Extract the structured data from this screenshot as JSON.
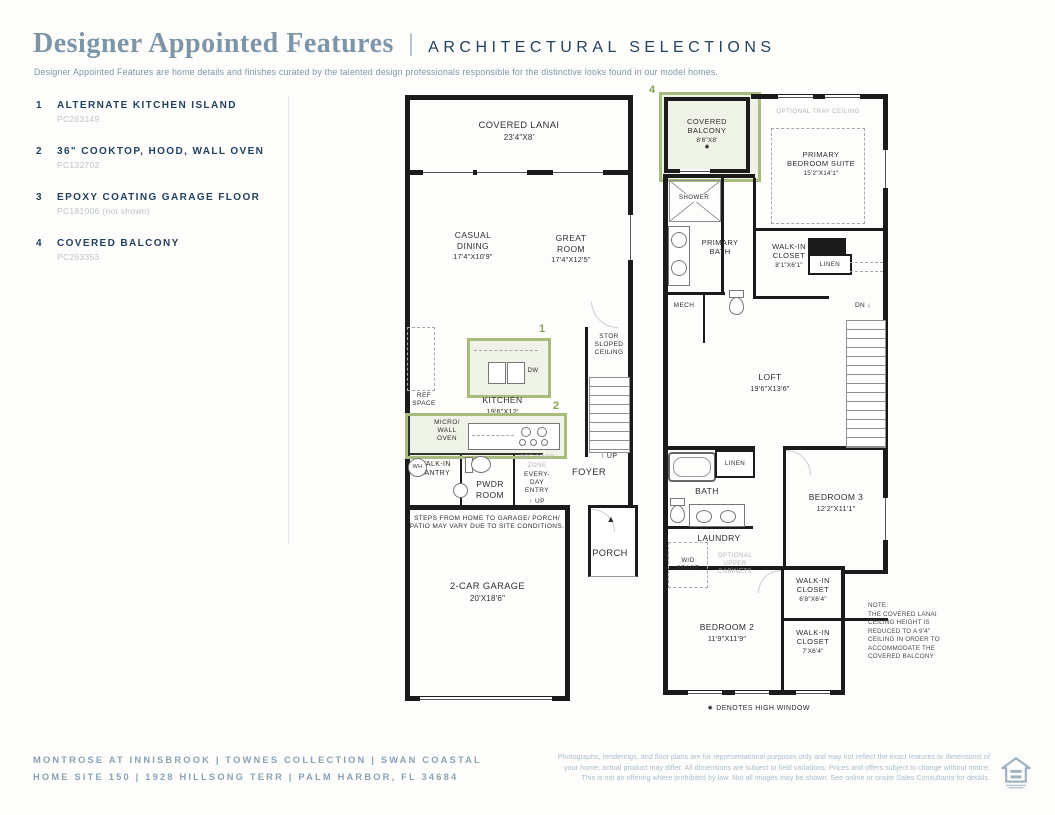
{
  "header": {
    "title": "Designer Appointed Features",
    "divider": "|",
    "subheading": "ARCHITECTURAL SELECTIONS",
    "description": "Designer Appointed Features are home details and finishes curated by the talented design professionals responsible for the distinctive looks found in our model homes."
  },
  "features": [
    {
      "number": "1",
      "label": "ALTERNATE KITCHEN ISLAND",
      "code": "PC263149"
    },
    {
      "number": "2",
      "label": "36\" COOKTOP, HOOD, WALL OVEN",
      "code": "PC132702"
    },
    {
      "number": "3",
      "label": "EPOXY COATING GARAGE FLOOR",
      "code": "PC181006 (not shown)"
    },
    {
      "number": "4",
      "label": "COVERED BALCONY",
      "code": "PC263353"
    }
  ],
  "plan1": {
    "lanai": {
      "name": "COVERED LANAI",
      "dims": "23'4\"X8'"
    },
    "casual_dining": {
      "name": "CASUAL\nDINING",
      "dims": "17'4\"X10'9\""
    },
    "great_room": {
      "name": "GREAT\nROOM",
      "dims": "17'4\"X12'5\""
    },
    "kitchen": {
      "name": "KITCHEN",
      "dims": "19'6\"X12'"
    },
    "island_marker": "1",
    "cooktop_marker": "2",
    "dw": "DW",
    "ref_space": "REF\nSPACE",
    "micro_wall_oven": "MICRO/\nWALL\nOVEN",
    "stor": "STOR\nSLOPED\nCEILING",
    "up_stairs": "UP",
    "walk_in_pantry": "WALK-IN\nPANTRY",
    "wh": "WH",
    "pwdr": "PWDR\nROOM",
    "opt_drop_zone": "OPT DROP\nZONE",
    "everyday_entry": "EVERY-\nDAY\nENTRY",
    "up_entry": "UP",
    "foyer": "FOYER",
    "porch": "PORCH",
    "steps_note": "STEPS FROM HOME TO GARAGE/ PORCH/\nPATIO MAY VARY DUE TO SITE CONDITIONS.",
    "garage": {
      "name": "2-CAR GARAGE",
      "dims": "20'X18'6\""
    }
  },
  "plan2": {
    "balcony_marker": "4",
    "balcony": {
      "name": "COVERED\nBALCONY",
      "dims": "8'6\"X8'",
      "star": "*"
    },
    "tray_ceiling": "OPTIONAL TRAY CEILING",
    "primary_bedroom": {
      "name": "PRIMARY\nBEDROOM SUITE",
      "dims": "15'2\"X14'1\""
    },
    "shower": "SHOWER",
    "primary_bath": "PRIMARY\nBATH",
    "mech": "MECH",
    "wic1": {
      "name": "WALK-IN\nCLOSET",
      "dims": "8'1\"X6'1\""
    },
    "linen1": "LINEN",
    "dn": "DN",
    "loft": {
      "name": "LOFT",
      "dims": "19'6\"X13'6\""
    },
    "linen2": "LINEN",
    "bath": "BATH",
    "laundry": "LAUNDRY",
    "wd_space": "W/D\nSPACE",
    "opt_upper_cabinets": "OPTIONAL\nUPPER\nCABINETS",
    "bedroom3": {
      "name": "BEDROOM 3",
      "dims": "12'2\"X11'1\""
    },
    "wic2": {
      "name": "WALK-IN\nCLOSET",
      "dims": "6'8\"X6'4\""
    },
    "bedroom2": {
      "name": "BEDROOM 2",
      "dims": "11'9\"X11'9\""
    },
    "wic3": {
      "name": "WALK-IN\nCLOSET",
      "dims": "7'X6'4\""
    },
    "high_window": {
      "star": "*",
      "text": "DENOTES HIGH WINDOW"
    }
  },
  "note": "NOTE:\nTHE COVERED LANAI\nCEILING HEIGHT IS\nREDUCED TO A 9'4\"\nCEILING IN ORDER TO\nACCOMMODATE THE\nCOVERED BALCONY",
  "footer": {
    "line1": "MONTROSE AT INNISBROOK  |  TOWNES COLLECTION  |  SWAN COASTAL",
    "line2": "HOME SITE 150  |  1928 HILLSONG TERR |  PALM HARBOR, FL 34684",
    "disclaimer": "Photographs, renderings, and floor plans are for representational purposes only and may not reflect the exact features or dimensions of\nyour home; actual product may differ. All dimensions are subject to field variations. Prices and offers subject to change without notice.\nThis is not an offering where prohibited by law. Not all images may be shown. See online or onsite Sales Consultants for details."
  },
  "icons": {
    "up_arrow": "↑",
    "dn_arrow": "↓",
    "entry_triangle": "▲"
  },
  "colors": {
    "accent_green": "#a8bd7d",
    "navy": "#24415e",
    "muted_blue": "#7e94a7",
    "wall": "#1b1b1b"
  }
}
